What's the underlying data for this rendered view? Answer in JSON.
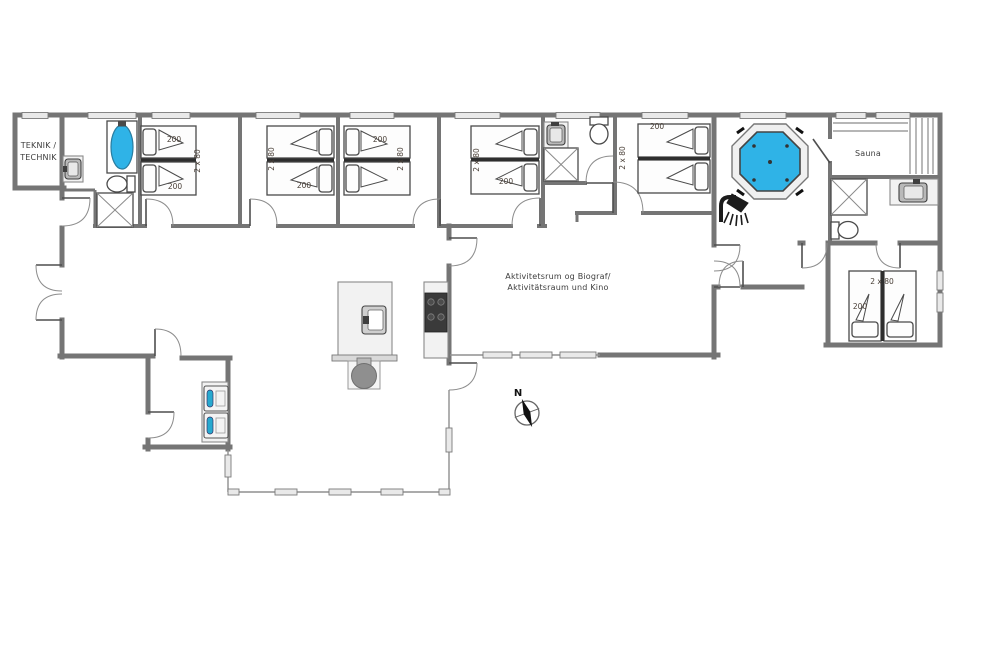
{
  "colors": {
    "wall": "#757575",
    "glass": "#8f8f8f",
    "window_fill": "#e9e9e9",
    "water_blue": "#2fb3e7",
    "appliance_teal": "#27a9cf",
    "fixture_dark": "#1c1c1c",
    "counter_fill": "#f2f2f2",
    "bed_stroke": "#4a4a4a",
    "text_color": "#3d3d3d"
  },
  "rooms": {
    "teknik": {
      "label_line1": "TEKNIK /",
      "label_line2": "TECHNIK"
    },
    "sauna": {
      "label": "Sauna"
    },
    "activity": {
      "label_line1": "Aktivitetsrum og Biograf/",
      "label_line2": "Aktivitätsraum und Kino"
    }
  },
  "beds": {
    "bedroom1": {
      "length_top": "200",
      "size": "2 x 80",
      "length_bottom": "200"
    },
    "bedroom2": {
      "size": "2 x 80",
      "length": "200"
    },
    "bedroom3": {
      "length": "200",
      "size": "2 x 80"
    },
    "bedroom4": {
      "size": "2 x 80",
      "length": "200"
    },
    "bedroom5": {
      "length": "200",
      "size": "2 x 80"
    },
    "bedroom6": {
      "size": "2 x 80",
      "length": "200"
    }
  },
  "compass": {
    "north_label": "N"
  }
}
